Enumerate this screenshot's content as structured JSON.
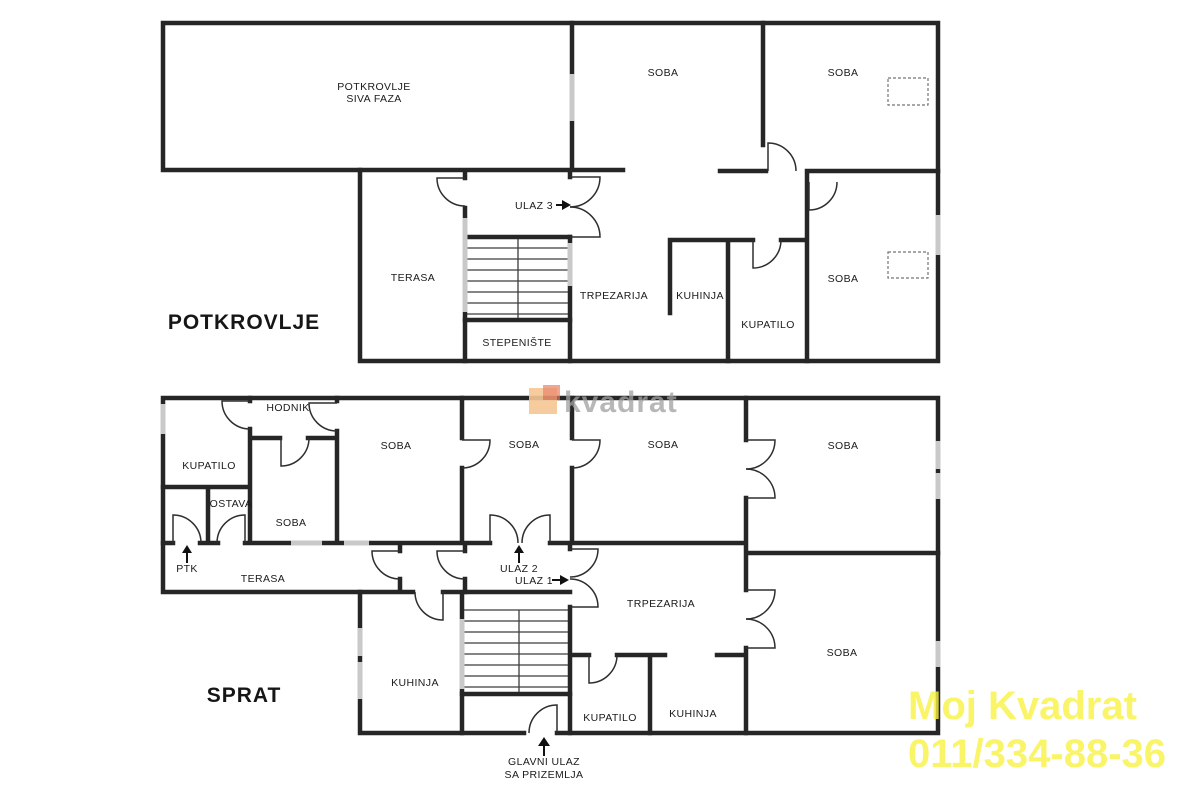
{
  "colors": {
    "background": "#ffffff",
    "wall": "#262626",
    "line_thin": "#3c3c3c",
    "window": "#c9c9c9",
    "label": "#1b1b1b",
    "watermark_text": "#a2a2a2",
    "logo_peach": "#f6c795",
    "logo_red": "#e77e5f",
    "agency_yellow": "#f8f243"
  },
  "watermark": {
    "text": "kvadrat"
  },
  "agency": {
    "name": "Moj Kvadrat",
    "phone": "011/334-88-36"
  },
  "floors": [
    {
      "title": "POTKROVLJE",
      "rooms": [
        {
          "label": "POTKROVLJE",
          "label2": "SIVA FAZA"
        },
        {
          "label": "SOBA"
        },
        {
          "label": "SOBA"
        },
        {
          "label": "TERASA"
        },
        {
          "label": "TRPEZARIJA"
        },
        {
          "label": "KUHINJA"
        },
        {
          "label": "KUPATILO"
        },
        {
          "label": "SOBA"
        },
        {
          "label": "STEPENIŠTE"
        }
      ],
      "entrances": [
        {
          "label": "ULAZ 3"
        }
      ]
    },
    {
      "title": "SPRAT",
      "rooms": [
        {
          "label": "KUPATILO"
        },
        {
          "label": "HODNIK"
        },
        {
          "label": "OSTAVA"
        },
        {
          "label": "SOBA"
        },
        {
          "label": "SOBA"
        },
        {
          "label": "SOBA"
        },
        {
          "label": "SOBA"
        },
        {
          "label": "SOBA"
        },
        {
          "label": "TERASA"
        },
        {
          "label": "TRPEZARIJA"
        },
        {
          "label": "KUHINJA"
        },
        {
          "label": "KUPATILO"
        },
        {
          "label": "KUHINJA"
        },
        {
          "label": "SOBA"
        }
      ],
      "entrances": [
        {
          "label": "PTK"
        },
        {
          "label": "ULAZ 2"
        },
        {
          "label": "ULAZ 1"
        },
        {
          "label": "GLAVNI ULAZ",
          "label2": "SA PRIZEMLJA"
        }
      ]
    }
  ]
}
